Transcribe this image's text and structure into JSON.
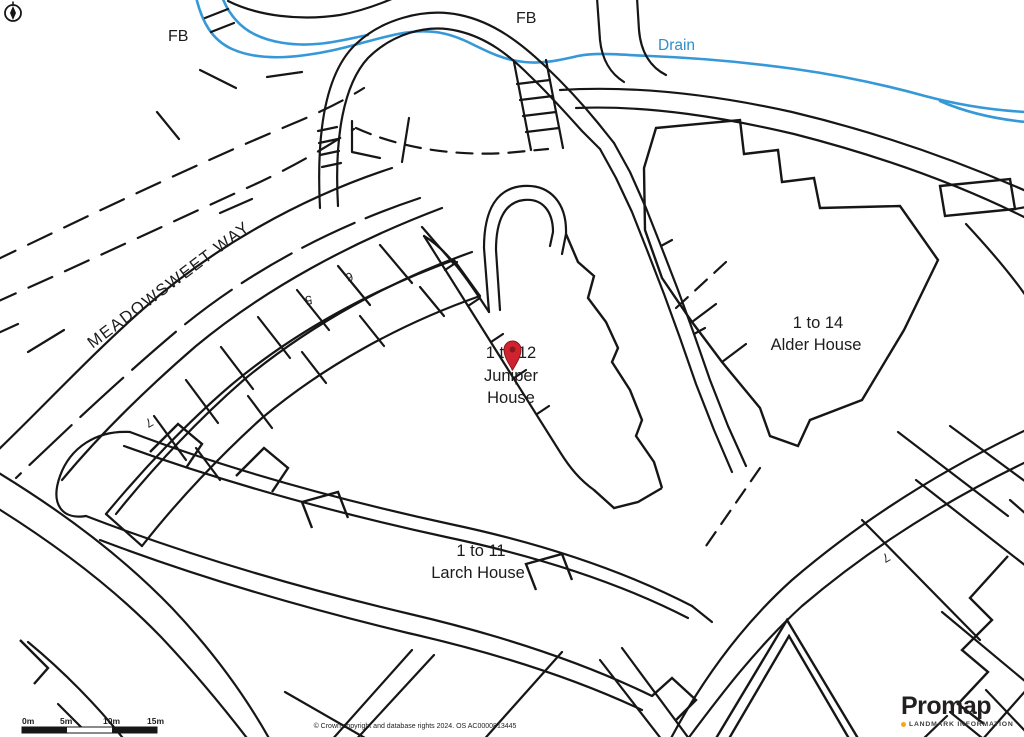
{
  "map": {
    "labels": {
      "fb_left": "FB",
      "fb_center": "FB",
      "drain": "Drain",
      "street": "MEADOWSWEET WAY",
      "plot_5": "5",
      "plot_6": "6",
      "plot_7_left": "7",
      "plot_7_right": "7"
    },
    "buildings": {
      "juniper": {
        "lines": [
          "1 to 12",
          "Juniper",
          "House"
        ]
      },
      "larch": {
        "lines": [
          "1 to 11",
          "Larch House"
        ]
      },
      "alder": {
        "lines": [
          "1 to 14",
          "Alder House"
        ]
      }
    },
    "colors": {
      "line": "#161616",
      "water": "#3598d8",
      "pin": "#d02330",
      "pin_dark": "#8e1620",
      "logo_dot": "#f5a623",
      "logo_text": "#231f20"
    },
    "icons": {
      "compass": "north-arrow",
      "marker": "location-pin"
    }
  },
  "scale_bar": {
    "labels": [
      "0m",
      "5m",
      "10m",
      "15m"
    ]
  },
  "attribution": {
    "text": "© Crown copyright and database rights 2024. OS AC0000813445"
  },
  "branding": {
    "name": "Promap",
    "tagline": "LANDMARK INFORMATION"
  }
}
